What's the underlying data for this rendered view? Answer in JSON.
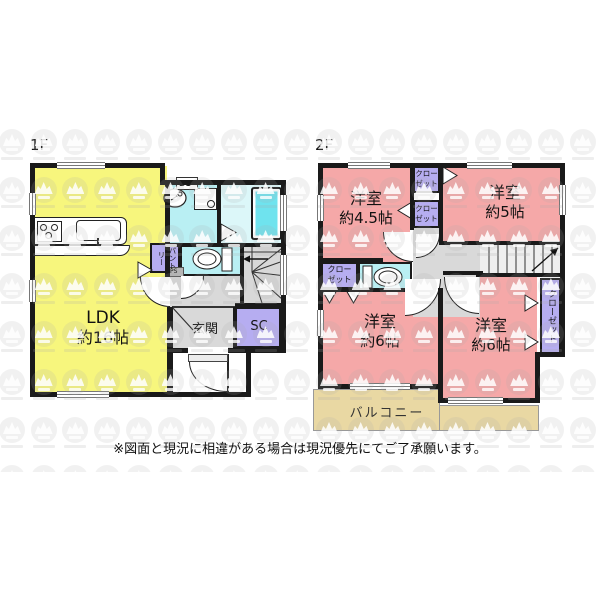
{
  "floor_labels": {
    "f1": "1F",
    "f2": "2F"
  },
  "rooms": {
    "ldk_name": "LDK",
    "ldk_size": "約16帖",
    "genkan": "玄関",
    "shoe_closet": "SC",
    "pantry": "パントリー",
    "duct_space": "DS",
    "pipe_space": "PS",
    "w45_name": "洋室",
    "w45_size": "約4.5帖",
    "w5_name": "洋室",
    "w5_size": "約5帖",
    "w6a_name": "洋室",
    "w6a_size": "約6帖",
    "w6b_name": "洋室",
    "w6b_size": "約6帖",
    "closet_l1": "クロー",
    "closet_l2": "ゼット",
    "closet_full": "クローゼット",
    "balcony": "バルコニー"
  },
  "note": "※図面と現況に相違がある場合は現況優先にてご了承願います。",
  "colors": {
    "ldk": "#f7f67d",
    "room": "#f5a8a8",
    "wet": "#b9eff3",
    "bath_floor": "#dcf7f9",
    "tub": "#6fe3ee",
    "closet": "#b6adf1",
    "hall": "#d9d9d9",
    "stairs": "#d8d8d8",
    "balcony": "#e9d8a3",
    "wall": "#1a1a1a"
  }
}
